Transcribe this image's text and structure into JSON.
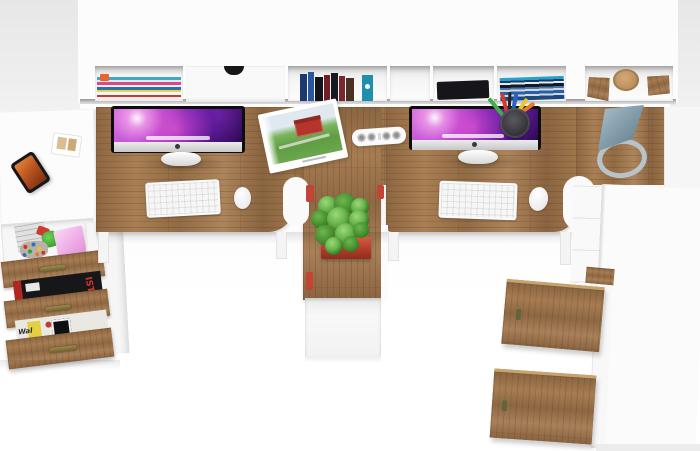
{
  "scene": {
    "title": "Top-down render of a white and oak double computer workstation with hutch shelving, open oak drawers, tall cabinet, two iMacs, desk lamp and potted plant",
    "palette": {
      "floor_gray": "#ececec",
      "furniture_white": "#fbfbfb",
      "oak_mid": "#9c7549",
      "oak_dark": "#7c5a38",
      "oak_light": "#ad855c",
      "screen_purple": "#5c14a0",
      "screen_pink": "#ff6edc",
      "plant_green": "#55a23c",
      "pot_red": "#c2402e",
      "lamp_blue_gray": "#8ba4b2",
      "brass_handle": "#8a7840",
      "case_black": "#16161a"
    },
    "objects": [
      "wall hutch with open cubbies",
      "magazine pile",
      "push drawer with finger notch",
      "row of standing books",
      "black document case",
      "flat stack of books",
      "wooden block bookends",
      "white return desk",
      "smartphone",
      "card tray",
      "open toy drawer",
      "pink gift box",
      "bead pile",
      "green toy figure",
      "three-drawer oak unit with brass handles",
      "stacked magazines between drawers",
      "L-shaped oak desktop",
      "iMac left",
      "iMac right",
      "white keyboard left",
      "white keyboard right",
      "white mouse left",
      "white mouse right",
      "open magazine with red barn photo",
      "white power strip",
      "mesh pencil cup with pens",
      "blue-gray desk lamp",
      "succulent in red pot on oak pedestal",
      "tall white cabinet with two open oak doors and keys"
    ]
  },
  "texts": {
    "magazine_ist": "IST",
    "newspaper_wal": "Wal"
  }
}
